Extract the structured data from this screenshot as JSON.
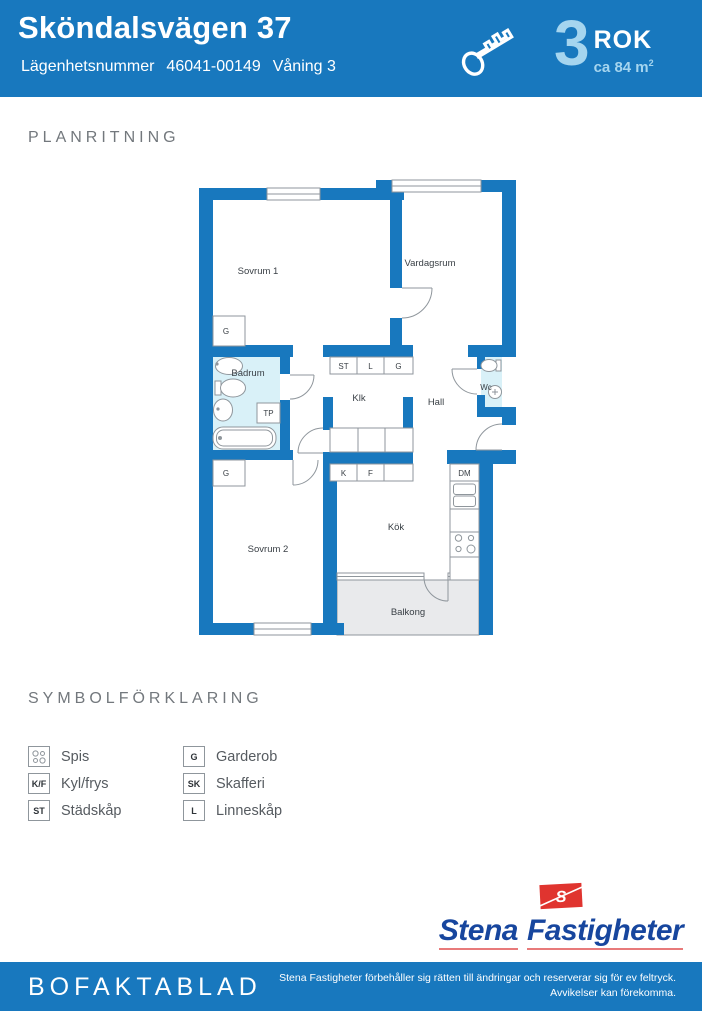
{
  "header": {
    "title": "Sköndalsvägen 37",
    "apartment_label": "Lägenhetsnummer",
    "apartment_number": "46041-00149",
    "floor": "Våning 3",
    "room_count": "3",
    "room_unit": "ROK",
    "area": "ca 84 m",
    "area_sup": "2"
  },
  "plan": {
    "section_title": "PLANRITNING",
    "rooms": {
      "sovrum1": "Sovrum 1",
      "vardagsrum": "Vardagsrum",
      "badrum": "Badrum",
      "klk": "Klk",
      "hall": "Hall",
      "wc": "Wc",
      "sovrum2": "Sovrum 2",
      "kok": "Kök",
      "balkong": "Balkong"
    },
    "markers": {
      "g_sovrum1": "G",
      "g_sovrum2": "G",
      "st": "ST",
      "l": "L",
      "g_hall": "G",
      "tp": "TP",
      "k": "K",
      "f": "F",
      "dm": "DM"
    },
    "colors": {
      "wall": "#1878be",
      "wet_room": "#d9f1f8",
      "balcony": "#e9eaec",
      "outline": "#8f969c"
    }
  },
  "legend": {
    "section_title": "SYMBOLFÖRKLARING",
    "items": [
      {
        "symbol": "",
        "label": "Spis"
      },
      {
        "symbol": "K/F",
        "label": "Kyl/frys"
      },
      {
        "symbol": "ST",
        "label": "Städskåp"
      },
      {
        "symbol": "G",
        "label": "Garderob"
      },
      {
        "symbol": "SK",
        "label": "Skafferi"
      },
      {
        "symbol": "L",
        "label": "Linneskåp"
      }
    ]
  },
  "logo": {
    "word1": "Stena",
    "word2": "Fastigheter",
    "flag_letter": "S"
  },
  "footer": {
    "title": "BOFAKTABLAD",
    "disclaimer_line1": "Stena Fastigheter förbehåller sig rätten till ändringar och reserverar sig för ev feltryck.",
    "disclaimer_line2": "Avvikelser kan förekomma."
  }
}
